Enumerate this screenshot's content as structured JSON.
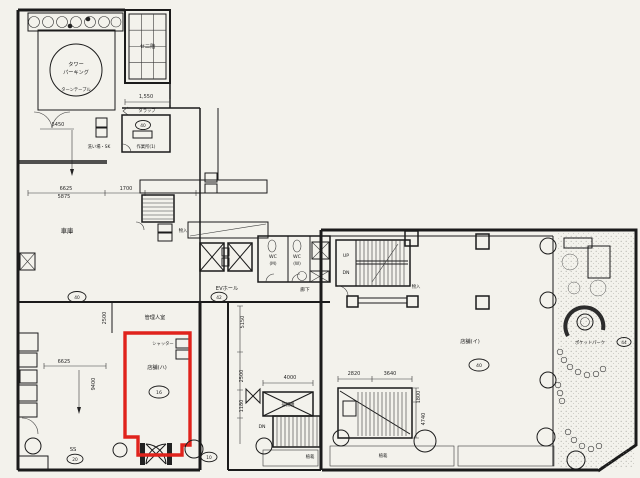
{
  "colors": {
    "paper": "#f3f2ec",
    "ink": "#1b1b1b",
    "highlight_red": "#e0231c"
  },
  "rooms": {
    "tower1": "タワー",
    "tower2": "パーキング",
    "turntable": "ターンテーブル",
    "mezz": "セ二階",
    "ladder": "タラップ",
    "workroom": "作業所(1)",
    "sink": "洗い場・SK",
    "garage": "車庫",
    "evhall": "EVホール",
    "corridor": "廊下",
    "wcm": "WC",
    "wcm_sub": "(M)",
    "wcw": "WC",
    "wcw_sub": "(W)",
    "closet1": "物入",
    "closet2": "物入",
    "manager": "管理人室",
    "shutter": "シャッター",
    "shop_red": "店舗(ハ)",
    "shop_main": "店舗(イ)",
    "ss": "SS",
    "pocket": "ポケットパーク",
    "planting1": "植栽",
    "planting2": "植栽",
    "lift": "荷揚機",
    "up": "UP",
    "dn1": "DN",
    "dn2": "DN"
  },
  "badges": {
    "workroom": "40",
    "garage": "40",
    "evhall": "42",
    "shop_red": "16",
    "ss": "20",
    "shop_main": "40",
    "pocket": "44",
    "entrance": "10"
  },
  "dims": {
    "d1550": "1,550",
    "d5450": "5450",
    "d6625_garage": "6625",
    "d5875": "5875",
    "d1700": "1700",
    "d2500_manager": "2500",
    "d5150": "5150",
    "d2500_mid": "2500",
    "d1180": "1180",
    "d4000": "4000",
    "d2820": "2820",
    "d3640": "3640",
    "d1800": "1800",
    "d4740": "4740",
    "d9400": "9400",
    "d6625_ss": "6625"
  }
}
